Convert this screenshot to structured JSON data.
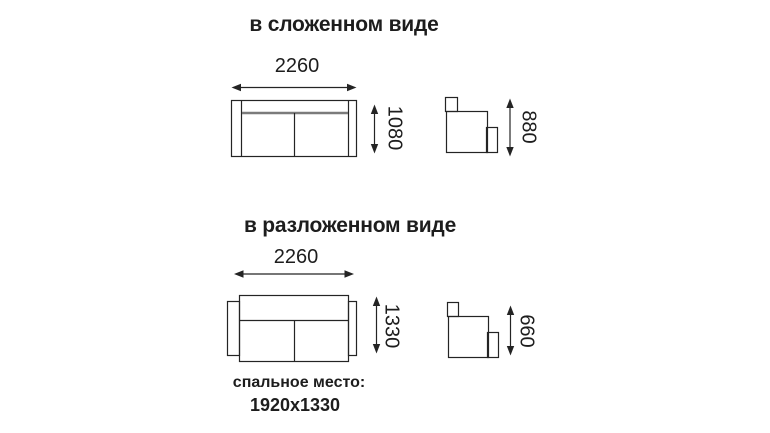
{
  "figure": {
    "folded": {
      "title": "в сложенном виде",
      "width_mm": "2260",
      "depth_mm": "1080",
      "height_mm": "880"
    },
    "unfolded": {
      "title": "в разложенном виде",
      "width_mm": "2260",
      "depth_mm": "1330",
      "height_mm": "660"
    },
    "sleeping_place": {
      "label": "спальное место:",
      "dimensions": "1920x1330"
    }
  },
  "colors": {
    "background": "#ffffff",
    "line": "#242424",
    "backrest_line": "#7b7b7b",
    "text": "#1d1d1d"
  }
}
